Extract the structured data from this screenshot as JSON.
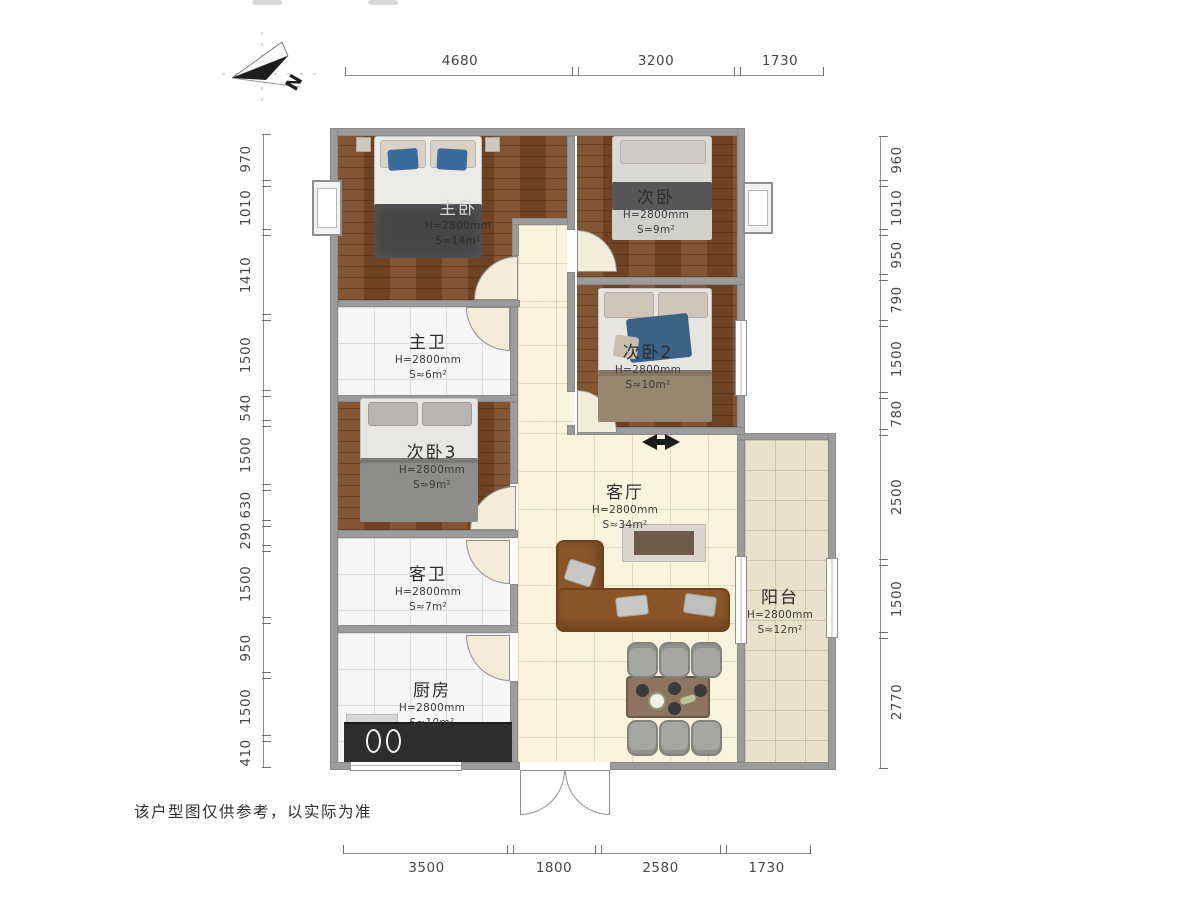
{
  "meta": {
    "disclaimer": "该户型图仅供参考，以实际为准",
    "north_label": "N"
  },
  "rooms": [
    {
      "id": "master-bedroom",
      "name": "主卧",
      "height": "H=2800mm",
      "area": "S≈14m²"
    },
    {
      "id": "bedroom-2",
      "name": "次卧",
      "height": "H=2800mm",
      "area": "S=9m²"
    },
    {
      "id": "bedroom-3",
      "name": "次卧2",
      "height": "H=2800mm",
      "area": "S≈10m²"
    },
    {
      "id": "master-bath",
      "name": "主卫",
      "height": "H=2800mm",
      "area": "S≈6m²"
    },
    {
      "id": "bedroom-4",
      "name": "次卧3",
      "height": "H=2800mm",
      "area": "S≈9m²"
    },
    {
      "id": "living-room",
      "name": "客厅",
      "height": "H=2800mm",
      "area": "S≈34m²"
    },
    {
      "id": "guest-bath",
      "name": "客卫",
      "height": "H=2800mm",
      "area": "S≈7m²"
    },
    {
      "id": "kitchen",
      "name": "厨房",
      "height": "H=2800mm",
      "area": "S≈10m²"
    },
    {
      "id": "balcony",
      "name": "阳台",
      "height": "H=2800mm",
      "area": "S≈12m²"
    }
  ],
  "dimensions": {
    "top": {
      "line": 75,
      "segments": [
        [
          "4680",
          345,
          575
        ],
        [
          "3200",
          575,
          737
        ],
        [
          "1730",
          737,
          823
        ]
      ]
    },
    "bottom": {
      "line": 853,
      "segments": [
        [
          "3500",
          343,
          510
        ],
        [
          "1800",
          510,
          598
        ],
        [
          "2580",
          598,
          723
        ],
        [
          "1730",
          723,
          810
        ]
      ]
    },
    "left": {
      "line": 263,
      "segments": [
        [
          "970",
          134,
          183
        ],
        [
          "1010",
          183,
          232
        ],
        [
          "1410",
          232,
          317
        ],
        [
          "1500",
          317,
          393
        ],
        [
          "540",
          393,
          423
        ],
        [
          "1500",
          423,
          487
        ],
        [
          "630",
          487,
          523
        ],
        [
          "290",
          523,
          548
        ],
        [
          "1500",
          548,
          620
        ],
        [
          "950",
          620,
          675
        ],
        [
          "1500",
          675,
          738
        ],
        [
          "410",
          738,
          767
        ]
      ]
    },
    "right": {
      "line": 880,
      "segments": [
        [
          "960",
          136,
          183
        ],
        [
          "1010",
          183,
          232
        ],
        [
          "950",
          232,
          277
        ],
        [
          "790",
          277,
          323
        ],
        [
          "1500",
          323,
          395
        ],
        [
          "780",
          395,
          432
        ],
        [
          "2500",
          432,
          562
        ],
        [
          "1500",
          562,
          635
        ],
        [
          "2770",
          635,
          768
        ]
      ]
    }
  },
  "colors": {
    "wood_floor": "#7b4a26",
    "tile_cream": "#faf4df",
    "tile_white": "#f6f6f6",
    "marble": "#e9e2ca",
    "wall": "#9c9c9c",
    "sofa": "#8a5527",
    "counter": "#2d2d2d",
    "accent_blue": "#3c6b9e",
    "blanket_dark": "#454548"
  }
}
